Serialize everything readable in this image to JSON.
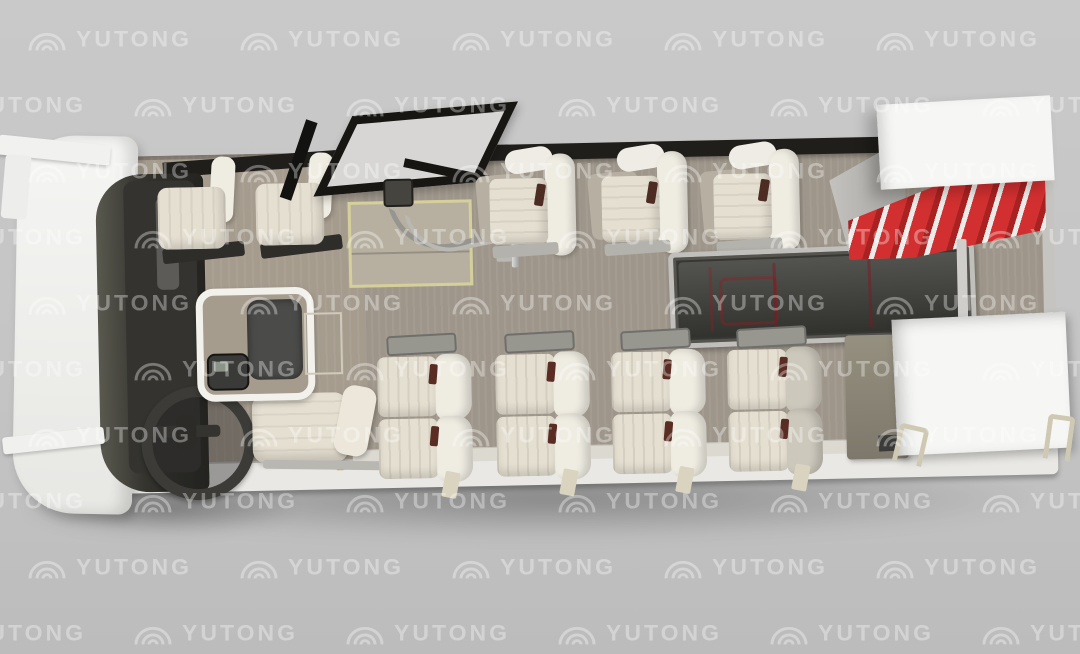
{
  "watermark": {
    "text": "YUTONG",
    "logo": "yutong-arcs-icon",
    "grid": {
      "rows": 11,
      "cols": 6,
      "row_height": 66,
      "col_width": 212,
      "row_stagger": 106,
      "start_x": -80,
      "start_y": -40
    }
  },
  "scene": {
    "subject": "top-down cutaway render of a luxury coach interior",
    "brand": "YUTONG",
    "driver_seats": 1,
    "lounge_chairs": 2,
    "single_seats_top_row": 3,
    "double_seat_pairs_bottom_row": 4,
    "sofa_sections": 3,
    "stair_steps": 5,
    "tables": 1,
    "entry_doors": 1
  },
  "colors": {
    "bg_top": "#c9c9c9",
    "bg_bottom": "#bcbcbc",
    "floor": "#9e968a",
    "lounge_floor": "#a59c8e",
    "step_floor": "#b7b0a1",
    "step_frame": "#d5cf9c",
    "wall_dark": "#201e1b",
    "glass_dark": "#24231f",
    "dash_dark": "#34332f",
    "seat_cream": "#e5dfd1",
    "seat_shell": "#efece2",
    "sofa_red": "#e2545e",
    "sofa_frame": "#c0bfbb",
    "stairs_red": "#d23030",
    "stair_stringer": "#ebebe9",
    "box_white": "#f6f6f4",
    "skirt_white": "#e9e8e4",
    "sideboard": "#95907f",
    "watermark": "rgba(255,255,255,0.34)"
  }
}
